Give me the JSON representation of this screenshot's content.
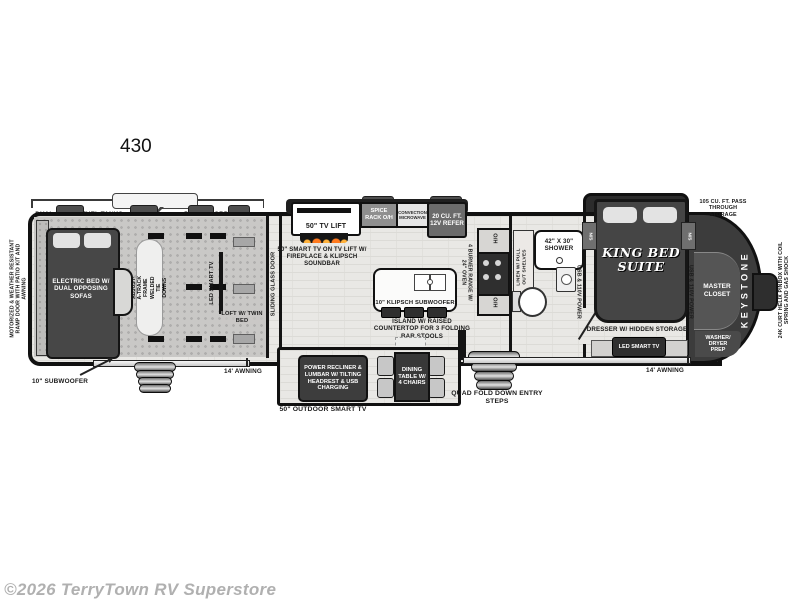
{
  "title": "430",
  "watermark": "©2026 TerryTown RV Superstore",
  "brand": "KEYSTONE",
  "exterior": {
    "ramp_door": "MOTORIZED & WEATHER RESISTANT RAMP DOOR WITH PATIO KIT AND AWNING",
    "fuel_tanks": "DUAL 30 GAL. FUEL TANKS",
    "cord_reel": "50 AMP CORD REEL",
    "subwoofer": "10\" SUBWOOFER",
    "awning_left": "14' AWNING",
    "awning_right": "14' AWNING",
    "outdoor_tv": "50\" OUTDOOR SMART TV",
    "entry_steps": "QUAD FOLD DOWN ENTRY STEPS",
    "pass_through": "105 CU. FT. PASS THROUGH STORAGE",
    "pinbox": "24K CURT HELIX PINBOX WITH COIL SPRING AND GAS SHOCK"
  },
  "garage": {
    "bed": "ELECTRIC BED W/ DUAL OPPOSING SOFAS",
    "tie_downs": "ADJUST-A-TRACK FRAME WELDED TIE DOWNS",
    "tv": "LED SMART TV",
    "loft": "LOFT W/ TWIN BED",
    "door": "SLIDING GLASS DOOR"
  },
  "kitchen": {
    "tv_lift": "50\" TV LIFT",
    "tv_note": "50\" SMART TV ON TV LIFT W/ FIREPLACE & KLIPSCH SOUNDBAR",
    "spice_rack": "SPICE RACK O/H",
    "microwave": "CONVECTION MICROWAVE",
    "refer": "20 CU. FT. 12V REFER",
    "island_sub": "10\" KLIPSCH SUBWOOFER",
    "island_note": "ISLAND W/ RAISED COUNTERTOP FOR 3 FOLDING BAR STOOLS",
    "range": "4 BURNER RANGE W/ 24\" OVEN",
    "oh": "O/H"
  },
  "living": {
    "recliner": "POWER RECLINER & LUMBAR W/ TILTING HEADREST & USB CHARGING",
    "dining": "DINING TABLE W/ 4 CHAIRS"
  },
  "bath": {
    "linen": "LINEN W/ PULL OUT SHELVES",
    "shower": "42\" X 30\" SHOWER"
  },
  "bedroom": {
    "bed": "KING BED SUITE",
    "usb": "USB & 110V POWER",
    "ns": "N/S",
    "dresser": "DRESSER W/ HIDDEN STORAGE",
    "tv": "LED SMART TV",
    "closet": "MASTER CLOSET",
    "washer": "WASHER/ DRYER PREP"
  },
  "colors": {
    "body_outline": "#111111",
    "furniture_dark": "#3f3f3f",
    "flame_orange": "#ff7a1e",
    "watermark_gray": "#b0b0b0"
  }
}
